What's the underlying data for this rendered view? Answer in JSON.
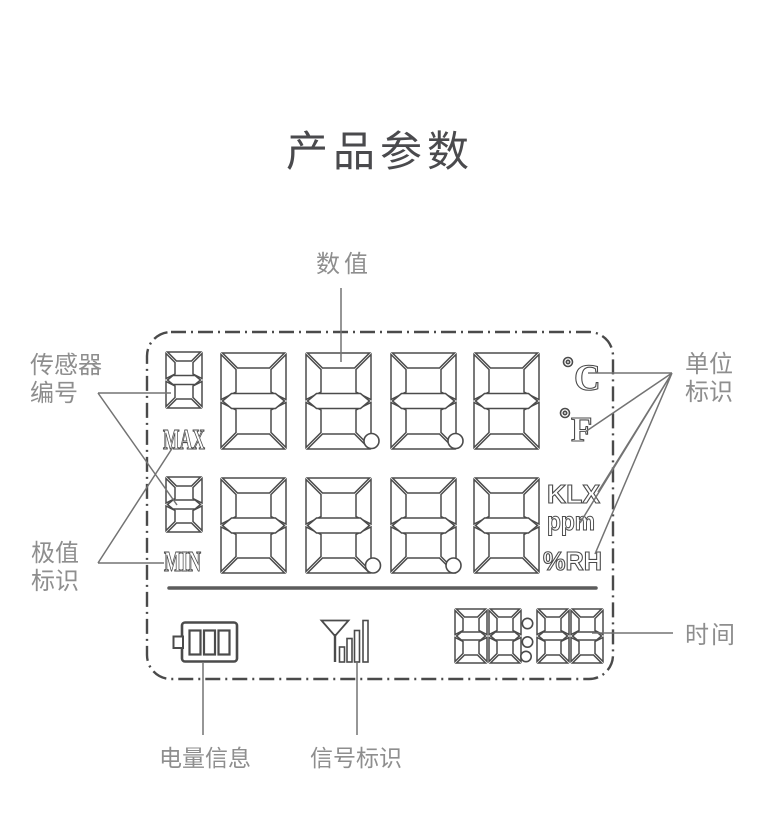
{
  "title": "产品参数",
  "annotations": {
    "value": "数值",
    "sensor_number": [
      "传感器",
      "编号"
    ],
    "extreme": [
      "极值",
      "标识"
    ],
    "unit": [
      "单位",
      "标识"
    ],
    "time": "时间",
    "battery": "电量信息",
    "signal": "信号标识"
  },
  "lcd": {
    "row1": {
      "sensor_digit": "8",
      "digits": "8888",
      "tag": "MAX"
    },
    "row2": {
      "sensor_digit": "8",
      "digits": "8888",
      "tag": "MIN"
    },
    "units_row1": [
      "C",
      "F"
    ],
    "units_row2": [
      "KLX",
      "ppm",
      "%RH"
    ],
    "time": "88:88"
  },
  "colors": {
    "lcd_stroke": "#4b4b4b",
    "annotation_text": "#8e8e8e",
    "leader_line": "#737373",
    "title_text": "#4a4a4d"
  }
}
